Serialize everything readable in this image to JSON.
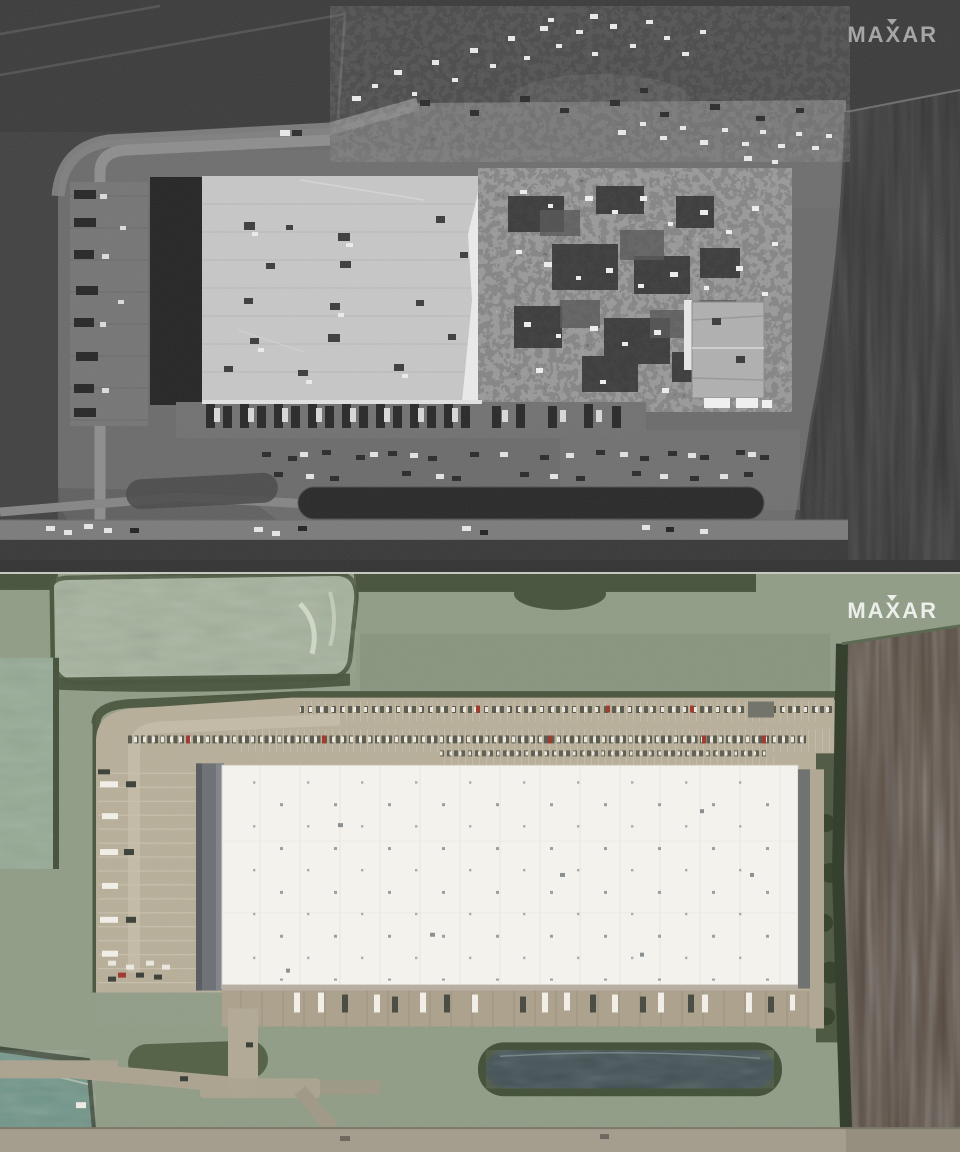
{
  "panels": {
    "after": {
      "watermark": "MAXAR"
    },
    "before": {
      "watermark": "MAXAR"
    }
  },
  "colors": {
    "after_bg": "#414141",
    "after_field_top": "#3b3b3b",
    "after_dark_field": "#313131",
    "after_pad": "#6b6b6b",
    "roof_after": "#c7c7c7",
    "before_field": "#8f9c85",
    "pond_pale": "#a4b29c",
    "pond_teal": "#6f9488",
    "pad_tan": "#b8af9a",
    "roof_before": "#f3f2ed",
    "retention_pond": "#3f4e52",
    "brown_field": "#55493f",
    "bottom_road": "#a59d8e"
  }
}
